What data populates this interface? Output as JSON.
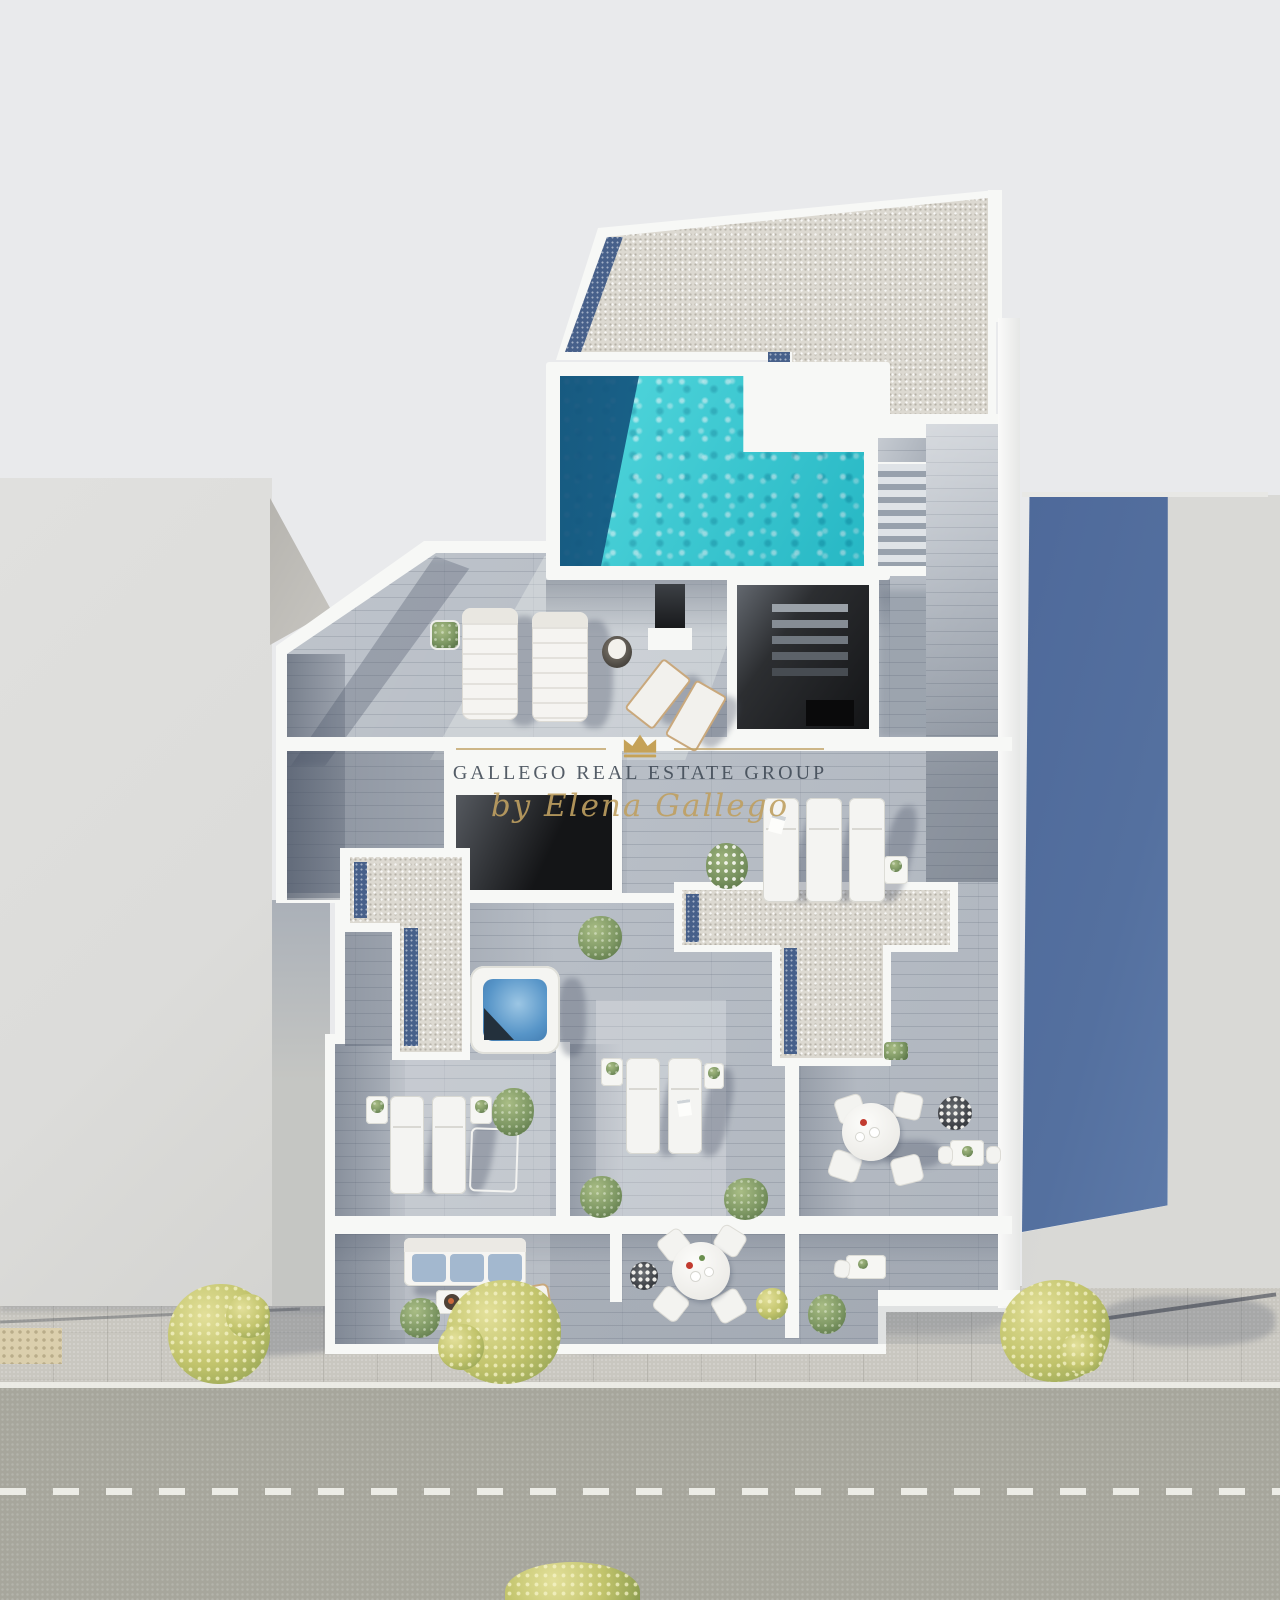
{
  "watermark": {
    "brand": "GALLEGO REAL ESTATE GROUP",
    "byline": "by Elena Gallego"
  },
  "colors": {
    "background": "#e9eaec",
    "street": "#a7a69c",
    "road_marking": "#f2f2ec",
    "sidewalk": "#c9c7c0",
    "tactile_paving": "#dbcfad",
    "left_building": "#dcdcda",
    "building_facet": "#b6b4af",
    "right_building_roof": "#d9d9d6",
    "right_building_shadow_face": "#54709f",
    "white_wall": "#f7f8f6",
    "gravel_roof": "#dcd9d1",
    "gravel_blue_border": "#47608a",
    "deck_wood": "#b9bfc7",
    "pool_water": "#2fd0d6",
    "pool_deep_end": "#124f78",
    "hot_tub_water": "#5795c8",
    "skylight_dark": "#141517",
    "foliage_green": "#7d9763",
    "foliage_yellow_green": "#c2c46c",
    "cushion_blue": "#a3b8cf",
    "wood_frame_tan": "#c9a87c",
    "watermark_text": "#3e4854",
    "watermark_gold": "#bfa061"
  }
}
